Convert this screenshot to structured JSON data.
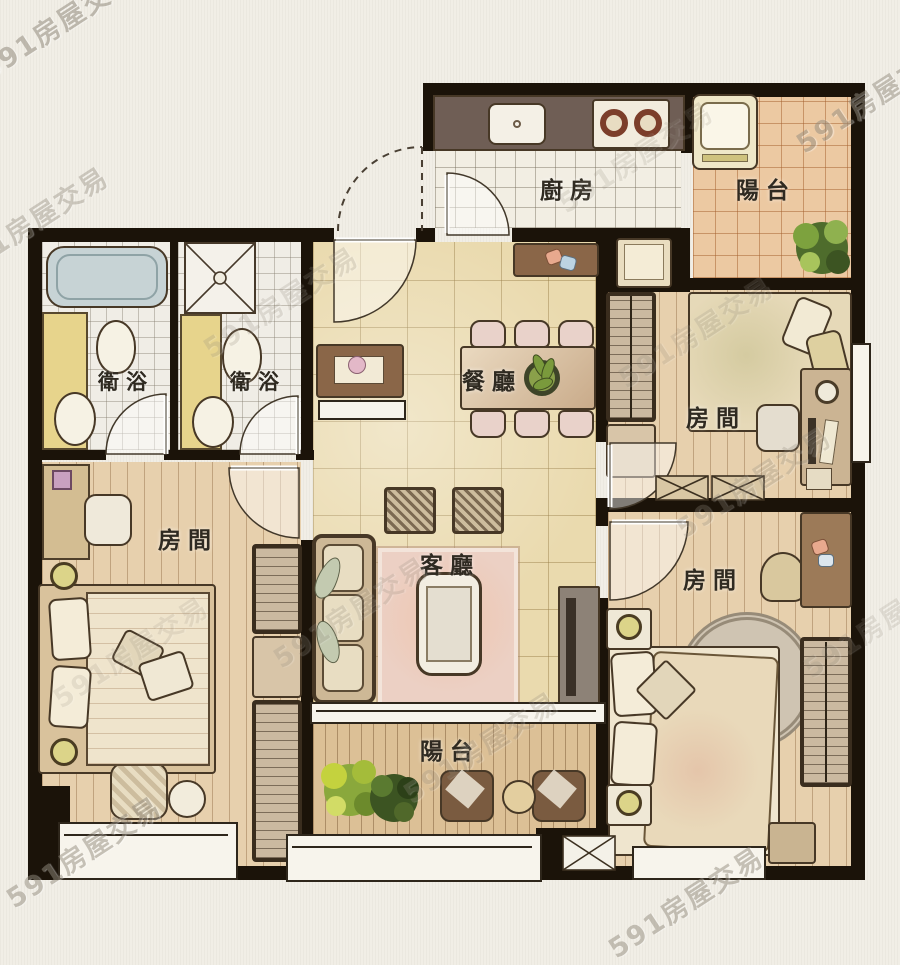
{
  "watermark": {
    "text": "591房屋交易"
  },
  "rooms": {
    "kitchen": {
      "label": "廚房"
    },
    "balcony_top": {
      "label": "陽台"
    },
    "bath_left": {
      "label": "衛浴"
    },
    "bath_right": {
      "label": "衛浴"
    },
    "dining": {
      "label": "餐廳"
    },
    "bedroom_top_right": {
      "label": "房間"
    },
    "bedroom_left": {
      "label": "房間"
    },
    "living": {
      "label": "客廳"
    },
    "bedroom_bottom_right": {
      "label": "房間"
    },
    "balcony_bottom": {
      "label": "陽台"
    }
  },
  "colors": {
    "wall": "#1b1309",
    "marble_floor": "#eadaae",
    "wood_floor": "#e7d0ad",
    "balcony_tile": "#ecc9a2",
    "white_tile": "#f2eee3",
    "rug": "#ecd0c4",
    "counter": "#6f5e55",
    "vanity_yellow": "#e7d48c"
  }
}
